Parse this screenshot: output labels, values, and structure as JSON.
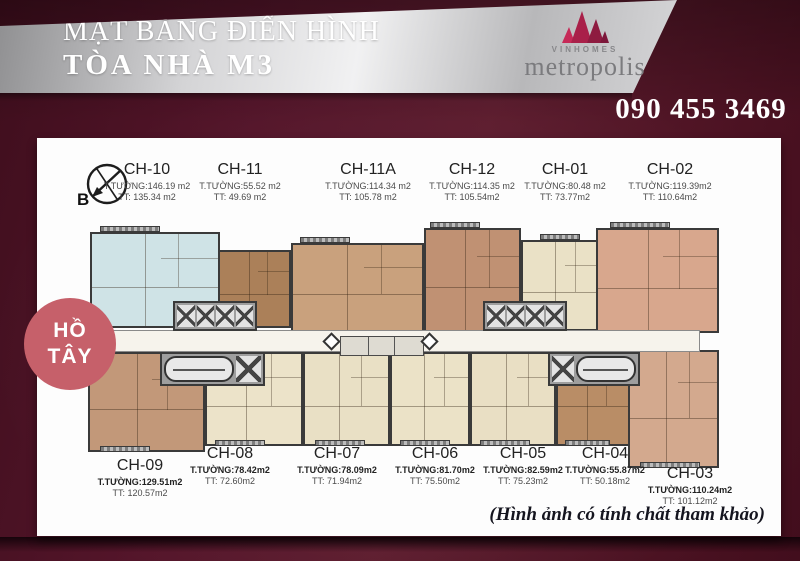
{
  "header": {
    "title_line1": "MẶT BẰNG ĐIỂN HÌNH",
    "title_line2": "TÒA NHÀ M3",
    "logo": {
      "brand": "VINHOMES",
      "name": "metropolis"
    },
    "phone": "090 455 3469"
  },
  "compass": {
    "label": "B"
  },
  "lake_badge": {
    "line1": "HỒ",
    "line2": "TÂY"
  },
  "disclaimer": "(Hình ảnh có tính chất tham khảo)",
  "colors": {
    "background_maroon": "#54152a",
    "banner_silver": "#e8e8ea",
    "logo_crimson": "#a92049",
    "lake_circle": "#c6606a",
    "phone_text": "#ffffff"
  },
  "apartments": [
    {
      "id": "CH-10",
      "wall_area": "T.TƯỜNG:146.19 m2",
      "net_area": "TT:  135.34 m2",
      "color": "#cfe3e6"
    },
    {
      "id": "CH-11",
      "wall_area": "T.TƯỜNG:55.52 m2",
      "net_area": "TT:  49.69 m2",
      "color": "#ab8059"
    },
    {
      "id": "CH-11A",
      "wall_area": "T.TƯỜNG:114.34 m2",
      "net_area": "TT:  105.78 m2",
      "color": "#c9a17d"
    },
    {
      "id": "CH-12",
      "wall_area": "T.TƯỜNG:114.35 m2",
      "net_area": "TT:  105.54m2",
      "color": "#c09173"
    },
    {
      "id": "CH-01",
      "wall_area": "T.TƯỜNG:80.48 m2",
      "net_area": "TT:  73.77m2",
      "color": "#eae1c6"
    },
    {
      "id": "CH-02",
      "wall_area": "T.TƯỜNG:119.39m2",
      "net_area": "TT:  110.64m2",
      "color": "#d8a78d"
    },
    {
      "id": "CH-09",
      "wall_area": "T.TƯỜNG:129.51m2",
      "net_area": "TT:  120.57m2",
      "color": "#c29879"
    },
    {
      "id": "CH-08",
      "wall_area": "T.TƯỜNG:78.42m2",
      "net_area": "TT:  72.60m2",
      "color": "#ece3c9"
    },
    {
      "id": "CH-07",
      "wall_area": "T.TƯỜNG:78.09m2",
      "net_area": "TT:  71.94m2",
      "color": "#e9e0c5"
    },
    {
      "id": "CH-06",
      "wall_area": "T.TƯỜNG:81.70m2",
      "net_area": "TT:  75.50m2",
      "color": "#ebe2c7"
    },
    {
      "id": "CH-05",
      "wall_area": "T.TƯỜNG:82.59m2",
      "net_area": "TT:  75.23m2",
      "color": "#e9dfc4"
    },
    {
      "id": "CH-04",
      "wall_area": "T.TƯỜNG:55.87m2",
      "net_area": "TT:  50.18m2",
      "color": "#b98d66"
    },
    {
      "id": "CH-03",
      "wall_area": "T.TƯỜNG:110.24m2",
      "net_area": "TT:  101.12m2",
      "color": "#d3a98e"
    }
  ]
}
